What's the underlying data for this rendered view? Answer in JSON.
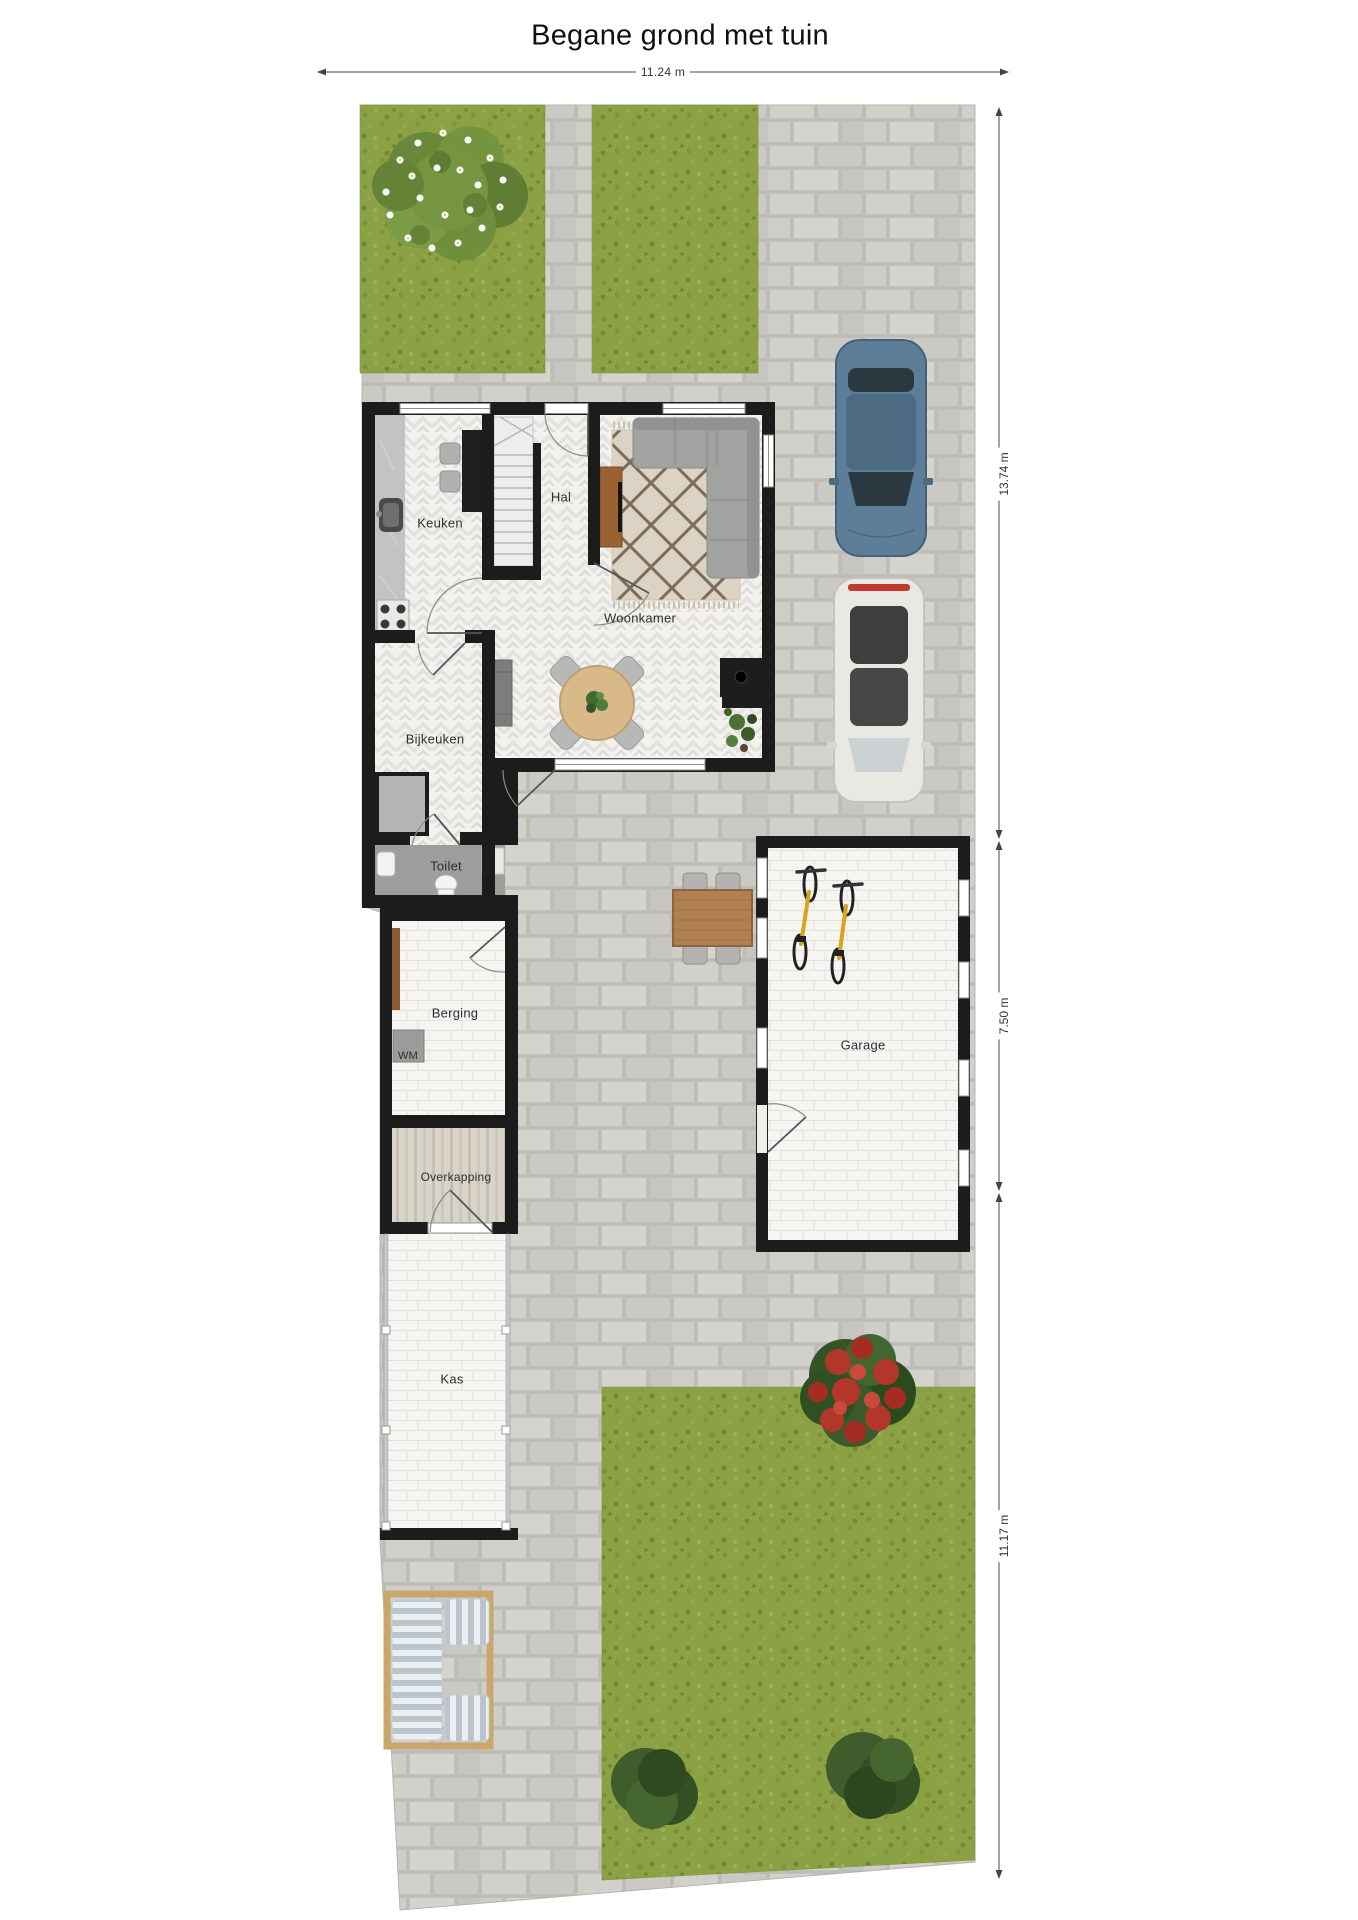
{
  "title": "Begane grond met tuin",
  "dimensions": {
    "top_width": "11.24 m",
    "right_upper": "13.74 m",
    "right_middle": "7.50 m",
    "right_lower": "11.17 m"
  },
  "rooms": {
    "keuken": "Keuken",
    "hal": "Hal",
    "woonkamer": "Woonkamer",
    "bijkeuken": "Bijkeuken",
    "toilet": "Toilet",
    "berging": "Berging",
    "wm": "WM",
    "overkapping": "Overkapping",
    "kas": "Kas",
    "garage": "Garage"
  },
  "colors": {
    "wall": "#1c1c1c",
    "paving": "#cbc9c4",
    "grass": "#8ba144",
    "house_floor": "#f3f2ef",
    "white_brick_floor": "#f6f5f2",
    "wood": "#b08050",
    "car_blue": "#5d7e98",
    "car_white": "#eae8e2",
    "bike_yellow": "#d6a51d",
    "bush_green": "#3e5c2c",
    "flower_red": "#b3362b"
  }
}
